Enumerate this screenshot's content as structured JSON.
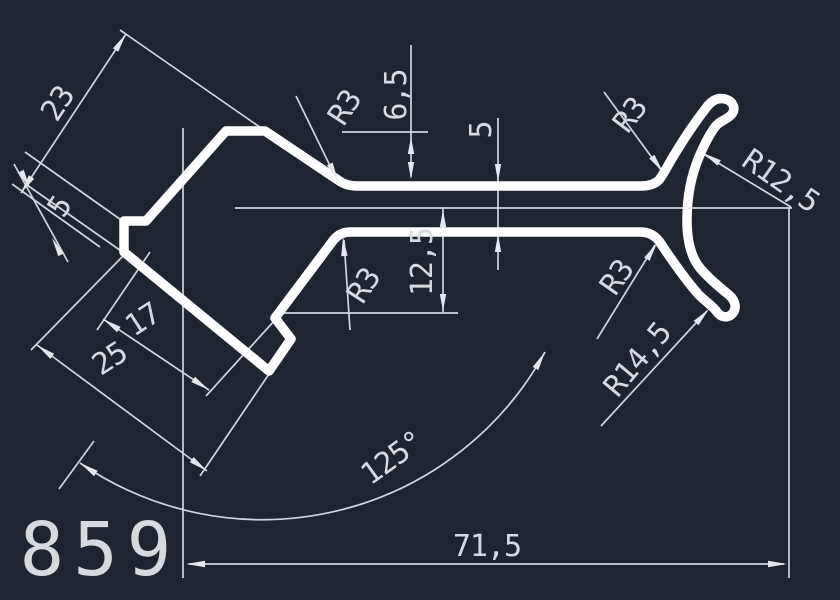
{
  "colors": {
    "background": "#1f2530",
    "profile": "#ffffff",
    "dim": "#d6dade"
  },
  "part_number": "859",
  "dimensions": {
    "length_23": "23",
    "step_5": "5",
    "width_17": "17",
    "width_25": "25",
    "height_6_5": "6,5",
    "wall_5": "5",
    "height_12_5": "12,5",
    "radius_r3_top_left": "R3",
    "radius_r3_top_right": "R3",
    "radius_r3_bottom_left": "R3",
    "radius_r3_bottom_right": "R3",
    "radius_r12_5": "R12,5",
    "radius_r14_5": "R14,5",
    "angle_125": "125°",
    "length_71_5": "71,5"
  }
}
